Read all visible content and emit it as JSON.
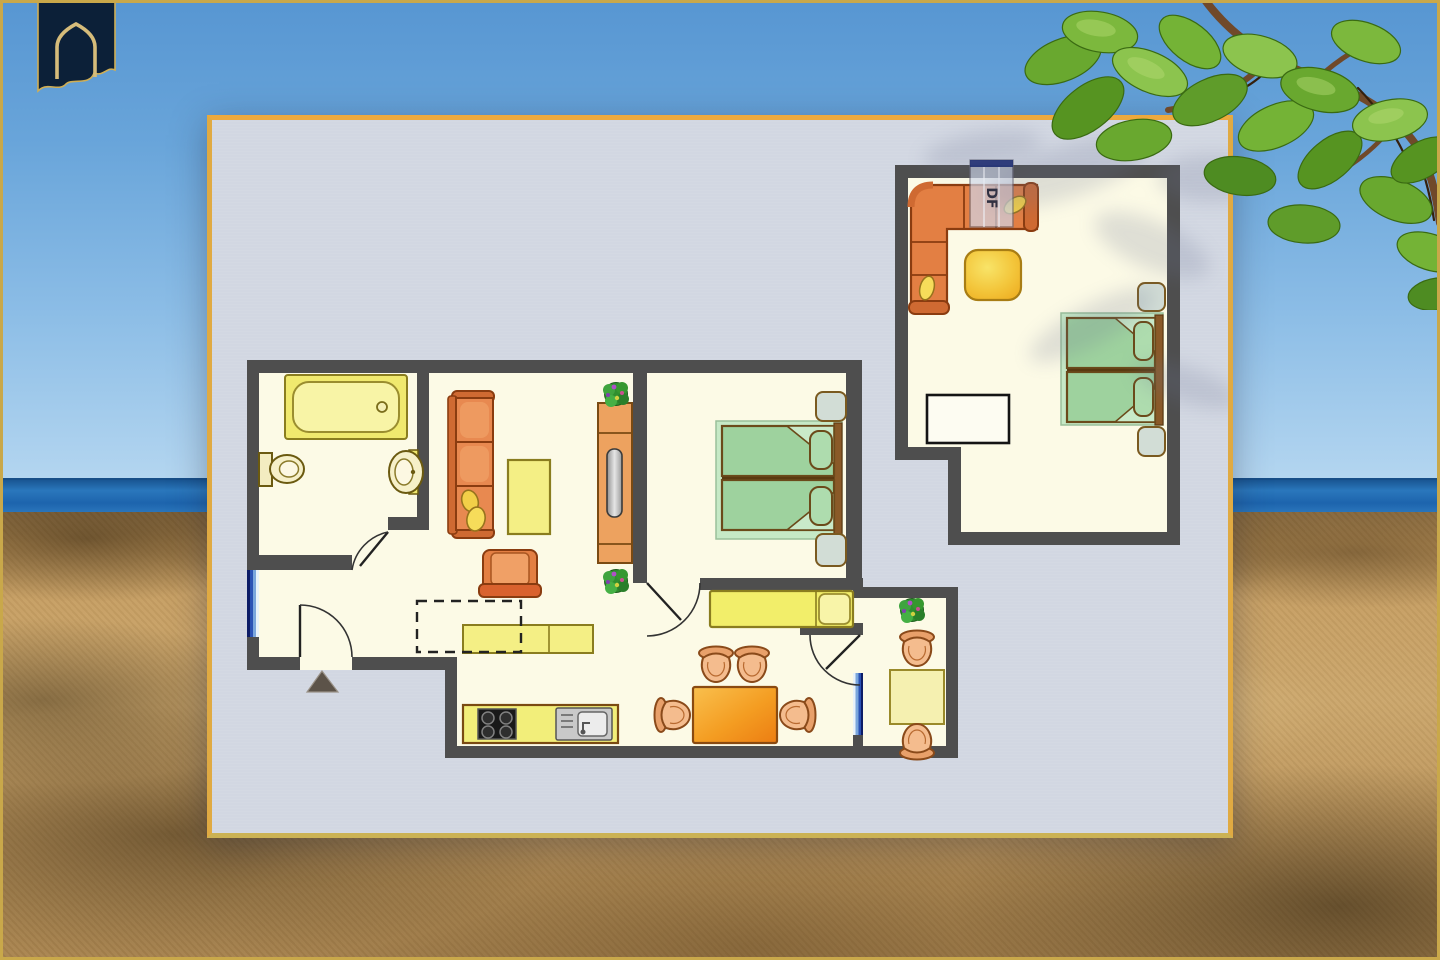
{
  "scene": {
    "description": "Apartment floor plan poster standing on a beach photo background",
    "background_elements": [
      "blue sky",
      "sea horizon band",
      "sandy beach with dunes",
      "foliage branch overhanging top right"
    ],
    "frame_color": "#c9a84a"
  },
  "logo": {
    "name": "navy banner with gold pointed-arch emblem",
    "banner_color": "#0c2038",
    "outline_color": "#cfae55"
  },
  "poster": {
    "border_color": "#e0aa42",
    "background_color": "#d2d7e2",
    "wall_color": "#4e4e4e",
    "floor_color": "#fcfae6"
  },
  "plan": {
    "roof_window_label": "DF",
    "window_count": 3,
    "rooms": [
      {
        "name": "bathroom",
        "furniture": [
          "bathtub",
          "toilet",
          "washbasin"
        ]
      },
      {
        "name": "living-room",
        "furniture": [
          "three-seat-sofa",
          "coffee-table",
          "armchair",
          "shelf-unit-with-mirror",
          "potted-plant",
          "potted-plant"
        ]
      },
      {
        "name": "bedroom",
        "furniture": [
          "double-bed",
          "nightstand",
          "nightstand"
        ]
      },
      {
        "name": "hallway",
        "furniture": [
          "single-bed",
          "sideboard",
          "dashed-reserved-area",
          "entrance-arrow"
        ]
      },
      {
        "name": "kitchen-dining",
        "furniture": [
          "kitchen-counter",
          "hob",
          "sink",
          "dining-table",
          "chair",
          "chair",
          "chair",
          "chair"
        ]
      },
      {
        "name": "annex-room",
        "furniture": [
          "table",
          "chair",
          "chair",
          "potted-plant"
        ]
      },
      {
        "name": "studio",
        "furniture": [
          "corner-sofa",
          "coffee-table",
          "double-bed",
          "nightstand",
          "nightstand",
          "desk",
          "roof-window"
        ]
      }
    ],
    "furniture_colors": {
      "yellow": "#f4ef85",
      "orange_sofa": "#e37f43",
      "green_bed": "#9fd3a0",
      "dining_table_orange": "#f09a28",
      "chair_tan": "#f0b183",
      "window_blue": "#2b52b4"
    }
  }
}
